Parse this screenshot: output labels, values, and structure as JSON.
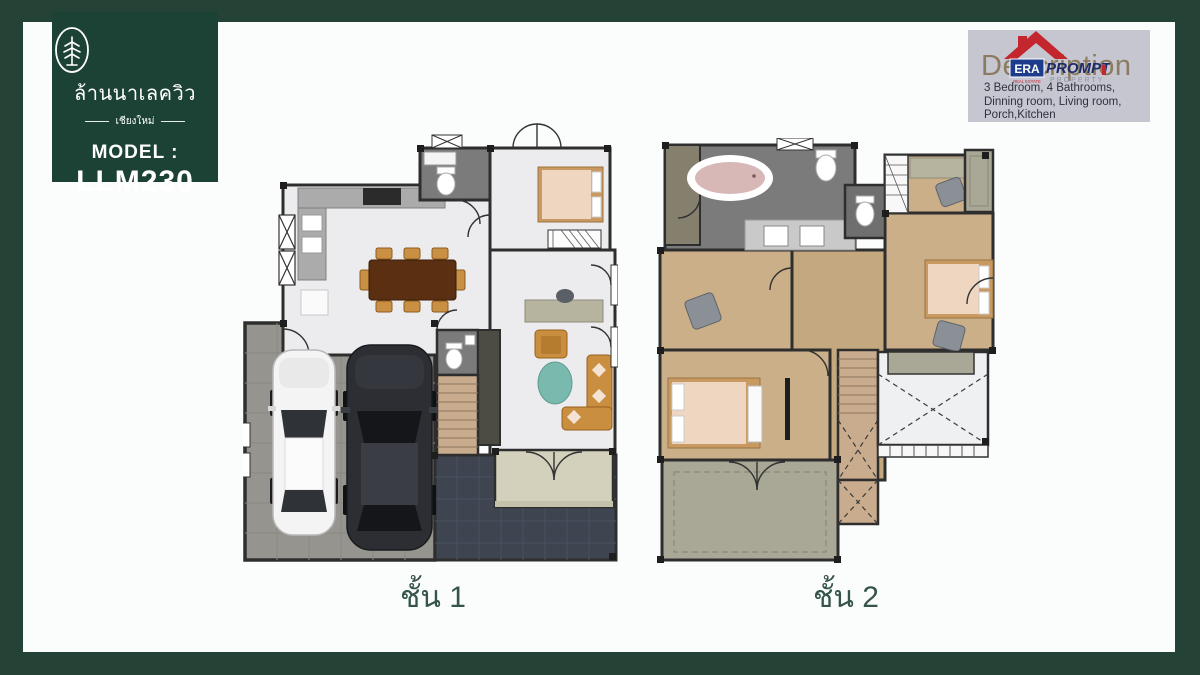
{
  "slide": {
    "background_color": "#254236",
    "card_color": "#fbfdfc"
  },
  "badge": {
    "background_color": "#1c4135",
    "logo_icon": "pine-tree-in-oval",
    "project_name_thai": "ล้านนาเลควิว",
    "location_thai": "เชียงใหม่",
    "model_label": "MODEL :",
    "model_code": "LLM230"
  },
  "description_box": {
    "background_color": "#c5c6d0",
    "heading_watermark": "Description",
    "broker_logo": {
      "name": "ERA PROMPT PROPERTY",
      "era": "ERA",
      "real_estate": "REAL ESTATE",
      "prompt": "PROMPT",
      "property": "PROPERTY"
    },
    "lines": [
      "3 Bedroom, 4 Bathrooms,",
      "Dinning room, Living room,",
      "Porch,Kitchen"
    ]
  },
  "floor_plans": [
    {
      "id": "floor-1",
      "label": "ชั้น 1"
    },
    {
      "id": "floor-2",
      "label": "ชั้น 2"
    }
  ],
  "palette": {
    "wall": "#2e2e2e",
    "floor_light": "#ececee",
    "bath_tile": "#7b7b7b",
    "wood_floor": "#cbaf88",
    "stair_wood": "#c9ac8e",
    "garage_floor": "#95948e",
    "terrace_tile": "#3f4550",
    "balcony_olive": "#a9a795",
    "porch_beige": "#d3d0bb",
    "sofa_orange": "#c98e3f",
    "rug_teal": "#7ab9ad",
    "dining_table_brown": "#5a2f12",
    "bed_mattress": "#eed6c0",
    "tub_pink": "#d8b7b7",
    "label_green": "#35544a",
    "era_red": "#c4262d",
    "era_blue": "#1e3c8c"
  }
}
